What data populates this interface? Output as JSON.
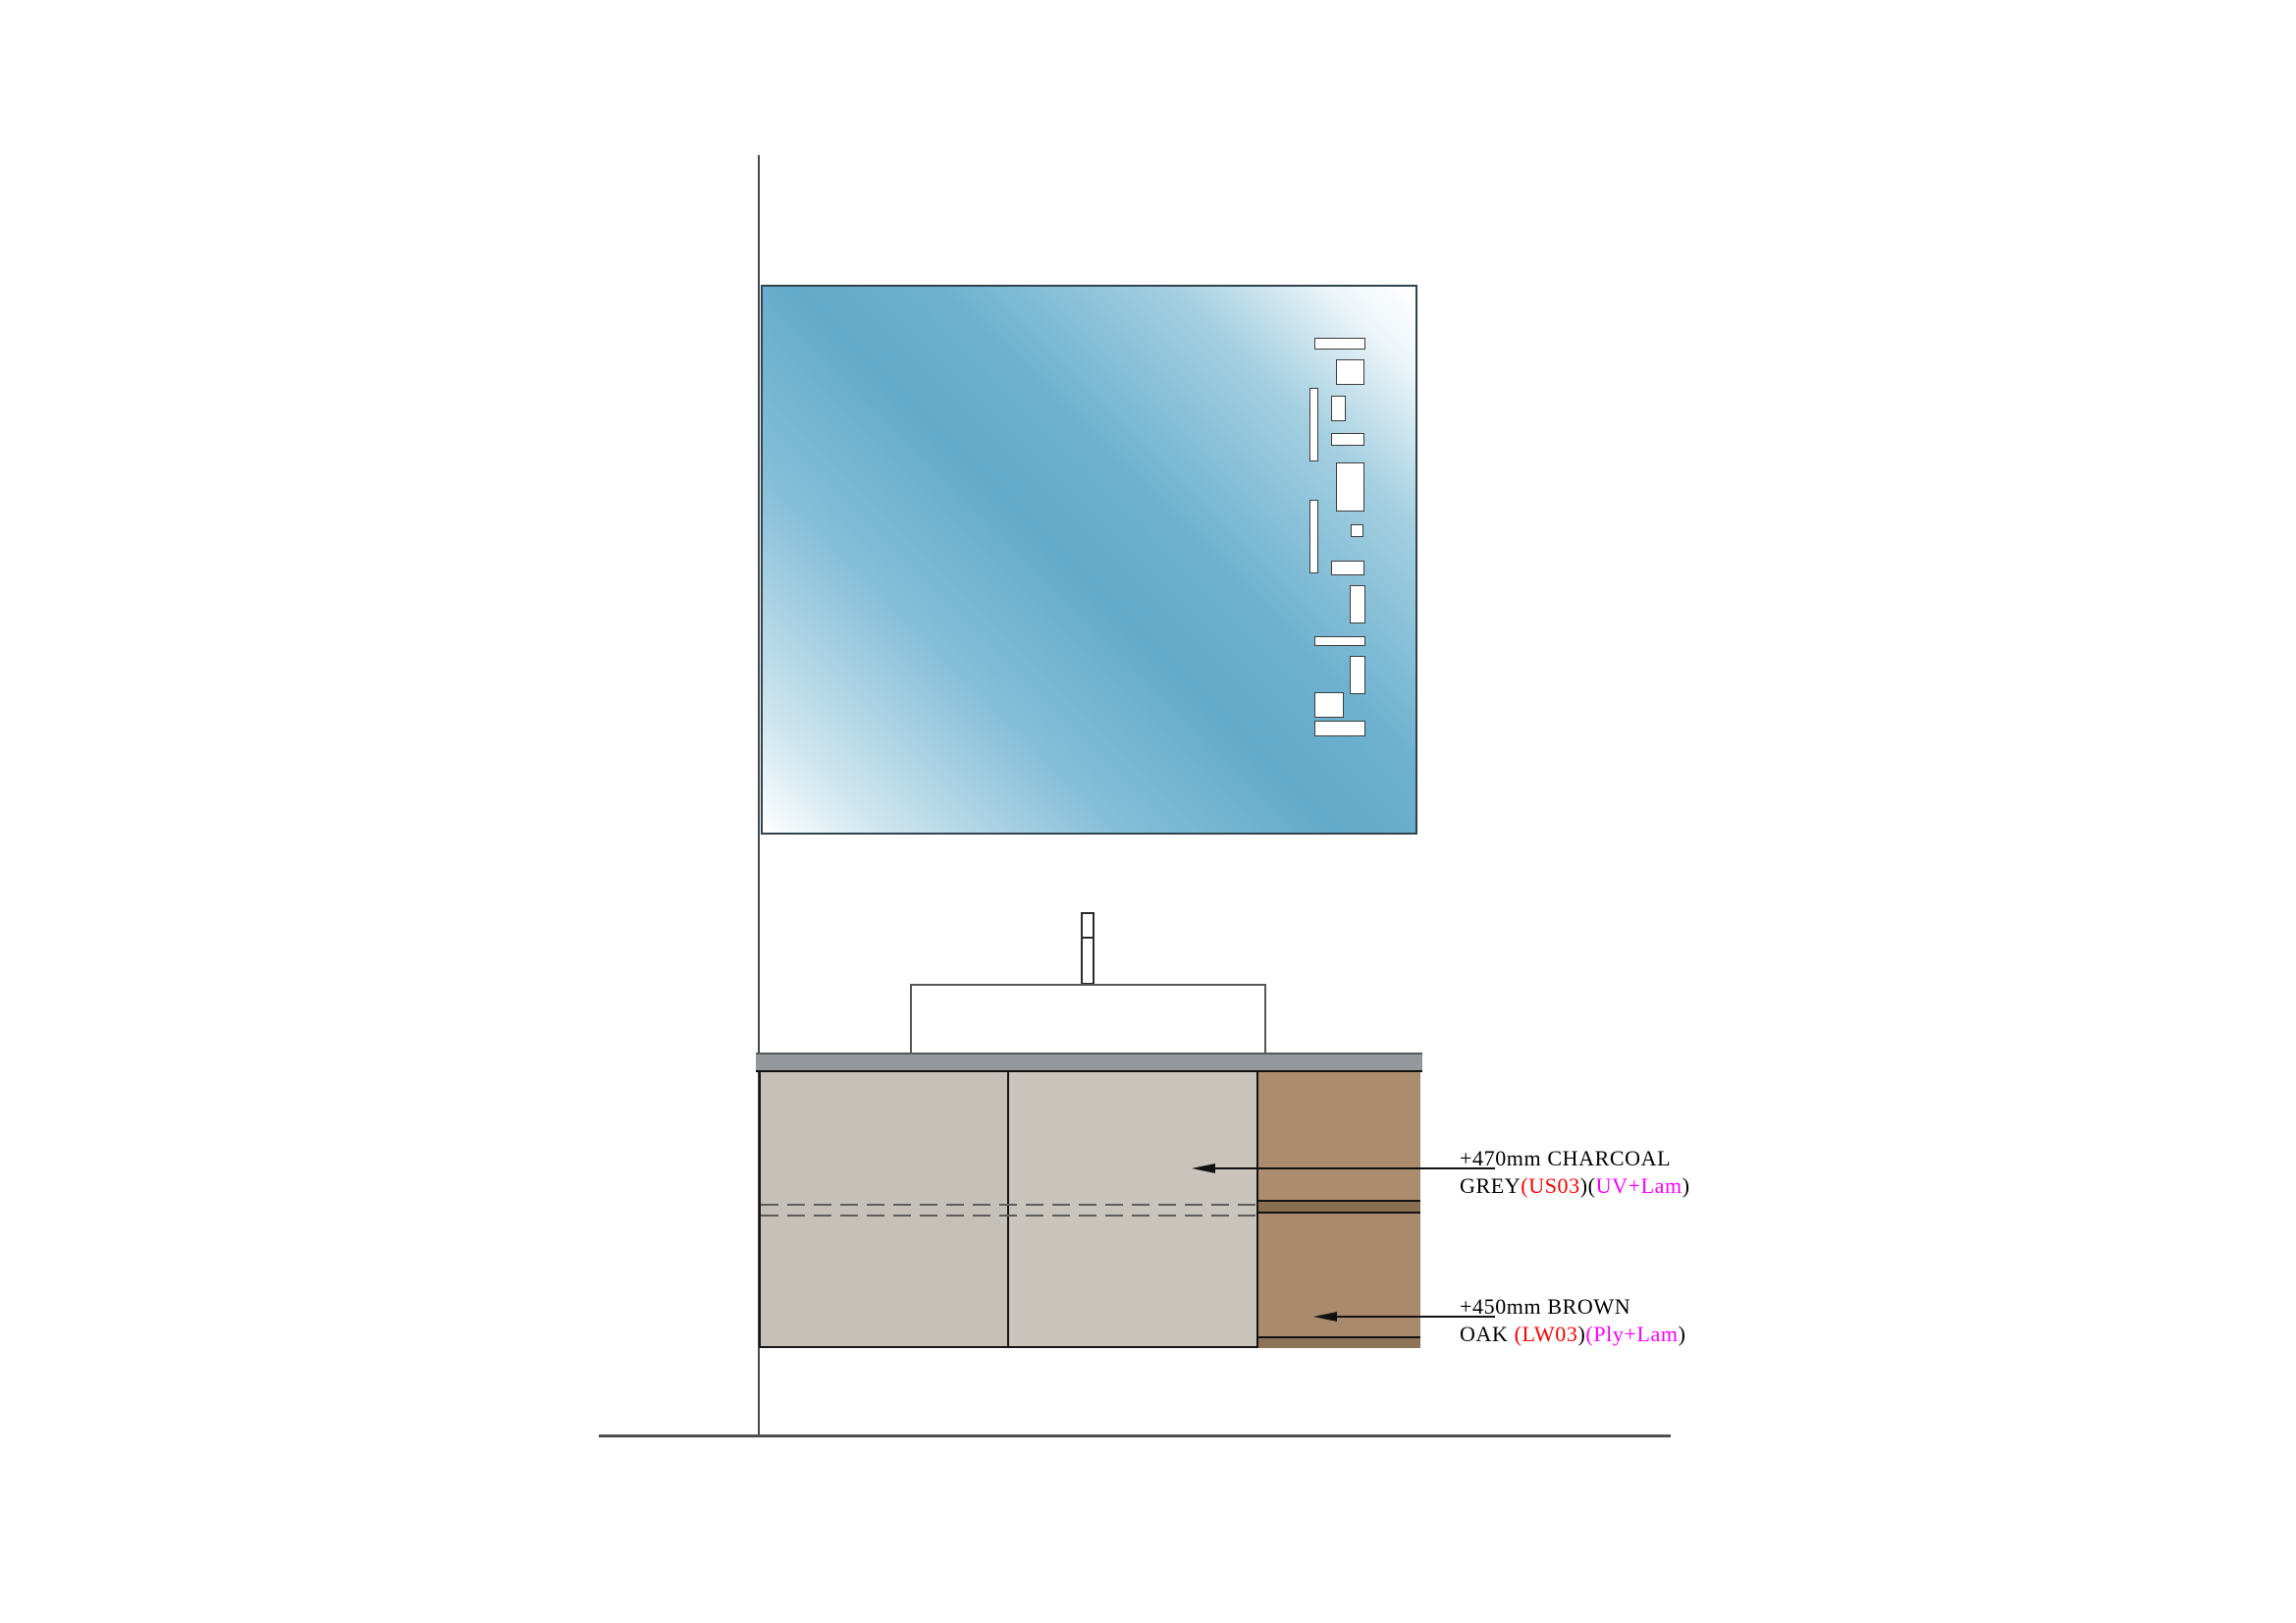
{
  "drawing": {
    "title": "bathroom vanity elevation",
    "annotations": [
      {
        "id": "charcoal-grey-panel",
        "line1": "+470mm CHARCOAL",
        "line2_segments": [
          {
            "text": "GREY",
            "color": "#000000"
          },
          {
            "text": "(US03",
            "color": "#ff0000"
          },
          {
            "text": ")(",
            "color": "#000000"
          },
          {
            "text": "UV+Lam",
            "color": "#ff00ff"
          },
          {
            "text": ")",
            "color": "#000000"
          }
        ]
      },
      {
        "id": "brown-oak-panel",
        "line1": "+450mm BROWN",
        "line2_segments": [
          {
            "text": "OAK ",
            "color": "#000000"
          },
          {
            "text": "(LW03",
            "color": "#ff0000"
          },
          {
            "text": ")",
            "color": "#000000"
          },
          {
            "text": "(Ply+Lam",
            "color": "#ff00ff"
          },
          {
            "text": ")",
            "color": "#000000"
          }
        ]
      }
    ],
    "mirror": {
      "pattern_rects": [
        [
          562,
          52,
          52,
          12
        ],
        [
          584,
          74,
          29,
          26
        ],
        [
          557,
          103,
          9,
          75
        ],
        [
          579,
          111,
          15,
          26
        ],
        [
          579,
          149,
          34,
          13
        ],
        [
          584,
          179,
          29,
          50
        ],
        [
          557,
          217,
          9,
          75
        ],
        [
          599,
          242,
          13,
          13
        ],
        [
          579,
          279,
          34,
          15
        ],
        [
          598,
          304,
          16,
          39
        ],
        [
          562,
          356,
          52,
          10
        ],
        [
          598,
          376,
          16,
          39
        ],
        [
          562,
          413,
          30,
          26
        ],
        [
          562,
          442,
          52,
          16
        ]
      ]
    },
    "colors": {
      "code_red": "#ff0000",
      "code_magenta": "#ff00ff",
      "mirror_blue": "#63abca",
      "mirror_highlight": "#ffffff",
      "countertop_gray": "#94979b",
      "door_taupe_left": "#c6c1b8",
      "door_taupe_right": "#c9c4bc",
      "drawer_brown_top": "#ab8c6e",
      "drawer_brown_bottom": "#a98a6c",
      "drawer_band_brown": "#8a6e51",
      "plinth_band_brown": "#8f7357",
      "outline_black": "#161616",
      "wall_line_gray": "#43484c"
    }
  }
}
